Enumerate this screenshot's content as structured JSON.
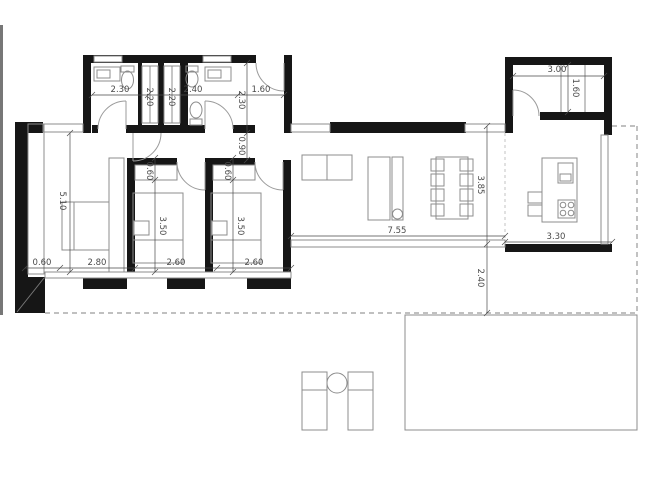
{
  "colors": {
    "wall": "#161616",
    "line": "#8c8c8c",
    "dim": "#4a4a4a",
    "dash": "#9a9a9a",
    "paper": "#ffffff"
  },
  "dims": {
    "bath1_width": "2.30",
    "bath2_width": "2.40",
    "entry_width": "1.60",
    "closet_strip_a": "2.20",
    "closet_strip_b": "2.20",
    "hall_depth": "2.30",
    "hall_passage": "0.90",
    "bed2_closet_depth": "0.60",
    "bed3_closet_depth": "0.60",
    "master_length": "5.10",
    "bed2_length": "3.50",
    "bed3_length": "3.50",
    "west_wall": "0.60",
    "master_width": "2.80",
    "bed2_width": "2.60",
    "bed3_width": "2.60",
    "living_width": "7.55",
    "living_depth": "3.85",
    "kitchen_width": "3.30",
    "store_width": "3.00",
    "store_depth": "1.60",
    "terrace_depth": "2.40"
  }
}
